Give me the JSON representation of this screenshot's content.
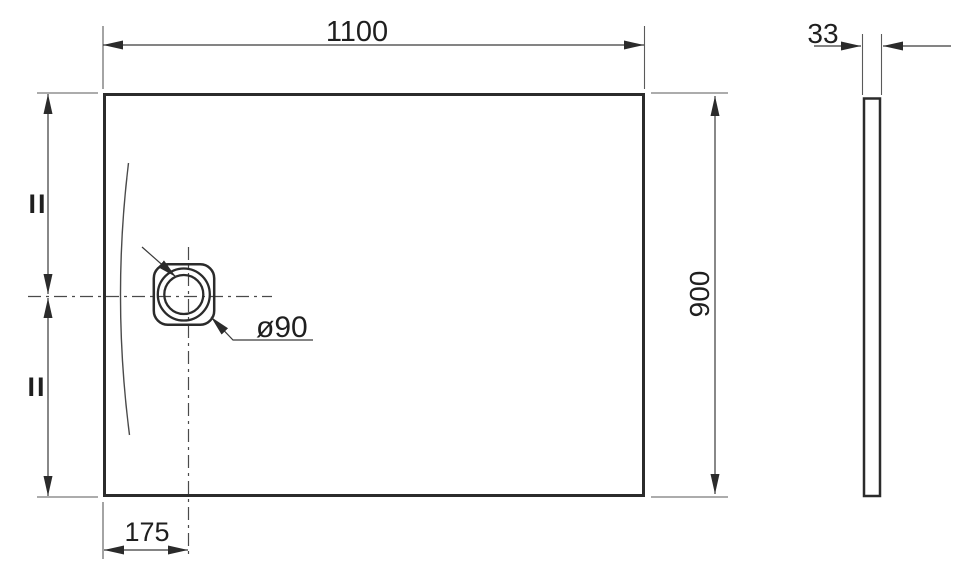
{
  "drawing": {
    "dim_width": "1100",
    "dim_height": "900",
    "dim_thickness": "33",
    "dim_drain_offset": "175",
    "dim_drain_diameter": "ø90",
    "equal_mark_top": "II",
    "equal_mark_bottom": "II"
  },
  "colors": {
    "background": "#ffffff",
    "outline": "#2b2b2b",
    "thin_line": "#5a5a5a",
    "centerline": "#4a4a4a",
    "text": "#1f1f1f"
  }
}
